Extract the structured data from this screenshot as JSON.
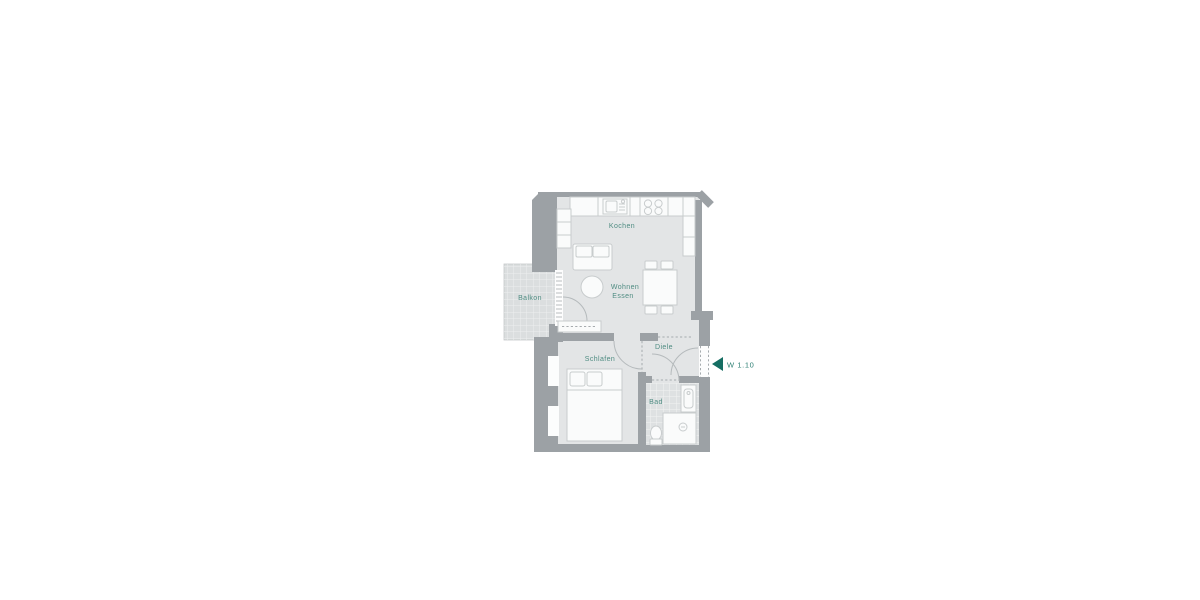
{
  "floor_plan": {
    "unit": {
      "label": "W 1.10"
    },
    "rooms": {
      "balkon": {
        "label": "Balkon"
      },
      "kochen": {
        "label": "Kochen"
      },
      "wohnen": {
        "label": "Wohnen"
      },
      "essen": {
        "label": "Essen"
      },
      "schlafen": {
        "label": "Schlafen"
      },
      "diele": {
        "label": "Diele"
      },
      "bad": {
        "label": "Bad"
      }
    },
    "colors": {
      "wall": "#9CA1A5",
      "floor": "#E3E5E6",
      "balcony_tile": "#DBDEDF",
      "bath_tile": "#DEE1E2",
      "furniture_outline": "#C8CCCD",
      "room_label": "#4F8C82",
      "entrance_accent": "#156E63"
    }
  }
}
